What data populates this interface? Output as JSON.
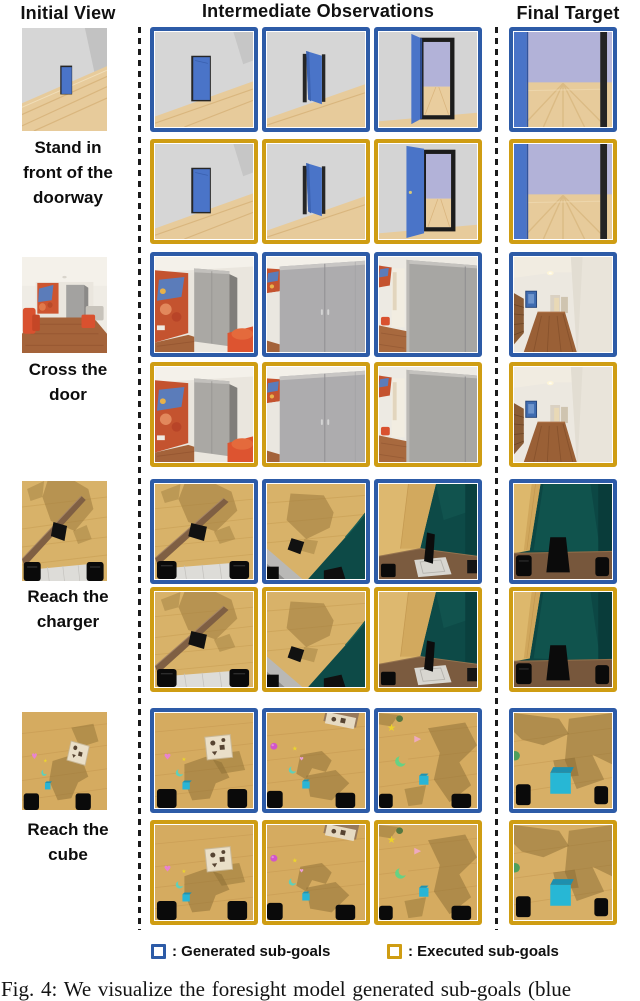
{
  "header": {
    "initial": "Initial View",
    "intermediate": "Intermediate Observations",
    "final": "Final Target"
  },
  "colors": {
    "generated_border": "#2d5ba7",
    "executed_border": "#cf9d13"
  },
  "legend": {
    "generated_label": ": Generated sub-goals",
    "executed_label": ": Executed sub-goals"
  },
  "caption": "Fig. 4: We visualize the foresight model generated sub-goals (blue",
  "rows": [
    {
      "task": "Stand in front of the doorway",
      "label_lines": "Stand in\nfront of the\ndoorway",
      "initial": "door-init",
      "generated": [
        "door-1",
        "door-2",
        "door-3"
      ],
      "executed": [
        "door-1",
        "door-2",
        "door-3x"
      ],
      "final_generated": "door-final",
      "final_executed": "door-final"
    },
    {
      "task": "Cross the door",
      "label_lines": "Cross the\ndoor",
      "initial": "hall-init",
      "generated": [
        "hall-1",
        "hall-2",
        "hall-3"
      ],
      "executed": [
        "hall-1",
        "hall-2",
        "hall-3"
      ],
      "final_generated": "hall-final",
      "final_executed": "hall-final"
    },
    {
      "task": "Reach the charger",
      "label_lines": "Reach the\ncharger",
      "initial": "chg-init",
      "generated": [
        "chg-1",
        "chg-2",
        "chg-3"
      ],
      "executed": [
        "chg-1",
        "chg-2",
        "chg-3"
      ],
      "final_generated": "chg-final",
      "final_executed": "chg-final"
    },
    {
      "task": "Reach the cube",
      "label_lines": "Reach the\ncube",
      "initial": "cube-init",
      "generated": [
        "cube-1",
        "cube-2",
        "cube-3"
      ],
      "executed": [
        "cube-1",
        "cube-2",
        "cube-3"
      ],
      "final_generated": "cube-final",
      "final_executed": "cube-final"
    }
  ]
}
